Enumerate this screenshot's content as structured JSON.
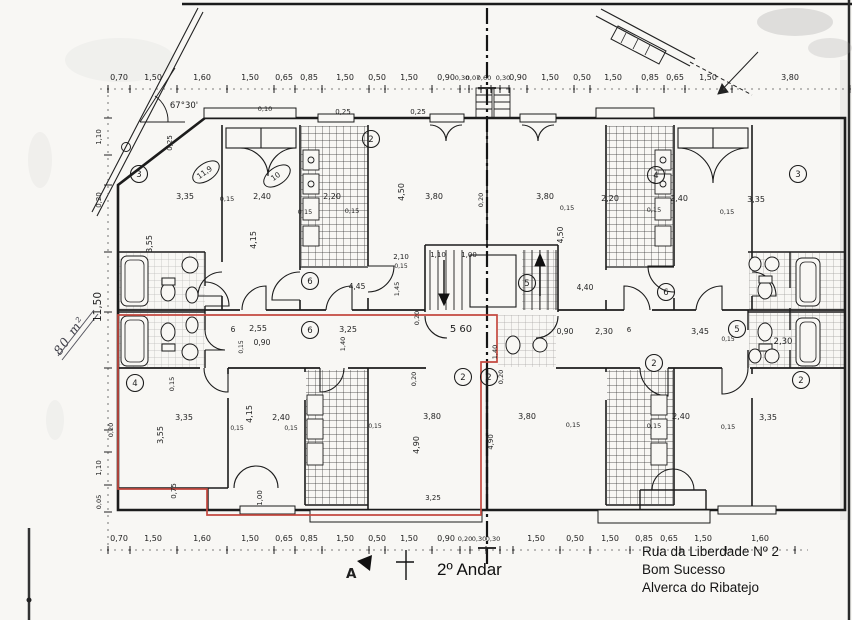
{
  "title": "2º Andar",
  "section": {
    "marker": "A"
  },
  "address": {
    "line1": "Rua da Liberdade Nº 2",
    "line2": "Bom Sucesso",
    "line3": "Alverca do Ribatejo"
  },
  "margin_notes": {
    "area_handwritten": "80 m²"
  },
  "colors": {
    "ink": "#1c1c1c",
    "red_outline": "#c4493f",
    "pencil": "#3c3c46",
    "paper": "#f8f7f4"
  },
  "dimension_chains": {
    "top": {
      "label_y": 80,
      "tick_y": 89,
      "ticks": [
        108,
        130,
        177,
        227,
        274,
        295,
        322,
        369,
        385,
        432,
        460,
        469,
        481,
        491,
        500,
        509,
        527,
        574,
        590,
        637,
        664,
        685,
        732,
        850
      ],
      "labels": [
        {
          "t": "0,70",
          "x": 119
        },
        {
          "t": "1,50",
          "x": 153
        },
        {
          "t": "1,60",
          "x": 202
        },
        {
          "t": "1,50",
          "x": 250
        },
        {
          "t": "0,65",
          "x": 284
        },
        {
          "t": "0,85",
          "x": 309
        },
        {
          "t": "1,50",
          "x": 345
        },
        {
          "t": "0,50",
          "x": 377
        },
        {
          "t": "1,50",
          "x": 409
        },
        {
          "t": "0,90",
          "x": 446
        },
        {
          "t": "0,30",
          "x": 462,
          "f": 6.5
        },
        {
          "t": "0,07",
          "x": 473,
          "f": 6.5
        },
        {
          "t": "0,60",
          "x": 484,
          "f": 6.5
        },
        {
          "t": "0,30",
          "x": 503,
          "f": 6.5
        },
        {
          "t": "0,90",
          "x": 518
        },
        {
          "t": "1,50",
          "x": 550
        },
        {
          "t": "0,50",
          "x": 582
        },
        {
          "t": "1,50",
          "x": 613
        },
        {
          "t": "0,85",
          "x": 650
        },
        {
          "t": "0,65",
          "x": 675
        },
        {
          "t": "1,50",
          "x": 708
        },
        {
          "t": "3,80",
          "x": 790
        }
      ]
    },
    "bottom": {
      "label_y": 541,
      "tick_y": 550,
      "ticks": [
        108,
        130,
        177,
        227,
        274,
        295,
        322,
        369,
        385,
        432,
        460,
        470,
        486,
        500,
        513,
        560,
        590,
        630,
        658,
        680,
        726,
        795
      ],
      "labels": [
        {
          "t": "0,70",
          "x": 119
        },
        {
          "t": "1,50",
          "x": 153
        },
        {
          "t": "1,60",
          "x": 202
        },
        {
          "t": "1,50",
          "x": 250
        },
        {
          "t": "0,65",
          "x": 284
        },
        {
          "t": "0,85",
          "x": 309
        },
        {
          "t": "1,50",
          "x": 345
        },
        {
          "t": "0,50",
          "x": 377
        },
        {
          "t": "1,50",
          "x": 409
        },
        {
          "t": "0,90",
          "x": 446
        },
        {
          "t": "0,20",
          "x": 465,
          "f": 6.5
        },
        {
          "t": "0,30",
          "x": 479,
          "f": 6.5
        },
        {
          "t": "0,30",
          "x": 493,
          "f": 6.5
        },
        {
          "t": "1,50",
          "x": 536
        },
        {
          "t": "0,50",
          "x": 575
        },
        {
          "t": "1,50",
          "x": 610
        },
        {
          "t": "0,85",
          "x": 644
        },
        {
          "t": "0,65",
          "x": 669
        },
        {
          "t": "1,50",
          "x": 703
        },
        {
          "t": "1,60",
          "x": 760
        }
      ]
    },
    "left": {
      "label_x": 101,
      "tick_x": 108,
      "ticks": [
        118,
        155,
        185,
        252,
        312,
        368,
        430,
        452,
        485,
        512
      ],
      "labels": [
        {
          "t": "1,10",
          "y": 137,
          "f": 7
        },
        {
          "t": "0,20",
          "y": 200,
          "f": 7
        },
        {
          "t": "11,50",
          "y": 307,
          "f": 10.5
        },
        {
          "t": "1,10",
          "y": 468,
          "f": 7
        },
        {
          "t": "0,05",
          "y": 502,
          "f": 6.5
        }
      ]
    }
  },
  "interior_dimensions": [
    {
      "t": "3,35",
      "x": 185,
      "y": 199
    },
    {
      "t": "0,15",
      "x": 227,
      "y": 201,
      "f": 6.5
    },
    {
      "t": "2,40",
      "x": 262,
      "y": 199
    },
    {
      "t": "0,15",
      "x": 305,
      "y": 214,
      "f": 6.5
    },
    {
      "t": "3,55",
      "x": 152,
      "y": 244,
      "r": -90
    },
    {
      "t": "4,15",
      "x": 256,
      "y": 240,
      "r": -90
    },
    {
      "t": "2,20",
      "x": 332,
      "y": 199
    },
    {
      "t": "0,15",
      "x": 352,
      "y": 213,
      "f": 6.5
    },
    {
      "t": "4,50",
      "x": 404,
      "y": 192,
      "r": -90
    },
    {
      "t": "3,80",
      "x": 434,
      "y": 199
    },
    {
      "t": "0,20",
      "x": 483,
      "y": 200,
      "r": -90,
      "f": 6.5
    },
    {
      "t": "2,10",
      "x": 401,
      "y": 259,
      "f": 7
    },
    {
      "t": "0,15",
      "x": 401,
      "y": 268,
      "f": 6
    },
    {
      "t": "1,10",
      "x": 438,
      "y": 257,
      "f": 7
    },
    {
      "t": "1,00",
      "x": 469,
      "y": 257,
      "f": 7
    },
    {
      "t": "0,25",
      "x": 343,
      "y": 114,
      "f": 7
    },
    {
      "t": "0,25",
      "x": 418,
      "y": 114,
      "f": 7
    },
    {
      "t": "0,10",
      "x": 265,
      "y": 111,
      "f": 6.5
    },
    {
      "t": "0,25",
      "x": 172,
      "y": 143,
      "r": -90,
      "f": 7
    },
    {
      "t": "67°30'",
      "x": 184,
      "y": 108,
      "f": 8.5
    },
    {
      "t": "4,45",
      "x": 357,
      "y": 289,
      "f": 7.5
    },
    {
      "t": "1,45",
      "x": 399,
      "y": 289,
      "r": -90,
      "f": 6.5
    },
    {
      "t": "6",
      "x": 233,
      "y": 332,
      "f": 7.5
    },
    {
      "t": "2,55",
      "x": 258,
      "y": 331
    },
    {
      "t": "0,90",
      "x": 262,
      "y": 345,
      "f": 7.5
    },
    {
      "t": "0,15",
      "x": 243,
      "y": 347,
      "r": -90,
      "f": 6
    },
    {
      "t": "1,40",
      "x": 345,
      "y": 344,
      "r": -90,
      "f": 6.5
    },
    {
      "t": "3,25",
      "x": 348,
      "y": 332
    },
    {
      "t": "5 60",
      "x": 461,
      "y": 332,
      "f": 10
    },
    {
      "t": "0,20",
      "x": 419,
      "y": 318,
      "r": -90,
      "f": 6.5
    },
    {
      "t": "1,40",
      "x": 497,
      "y": 352,
      "r": -90,
      "f": 6.5
    },
    {
      "t": "4,40",
      "x": 585,
      "y": 290,
      "f": 7.5
    },
    {
      "t": "0,90",
      "x": 565,
      "y": 334,
      "f": 7.5
    },
    {
      "t": "2,30",
      "x": 604,
      "y": 334
    },
    {
      "t": "6",
      "x": 629,
      "y": 332,
      "f": 7
    },
    {
      "t": "3,45",
      "x": 700,
      "y": 334
    },
    {
      "t": "0,15",
      "x": 728,
      "y": 341,
      "f": 6
    },
    {
      "t": "2,30",
      "x": 783,
      "y": 344,
      "f": 8.5
    },
    {
      "t": "2,20",
      "x": 610,
      "y": 201
    },
    {
      "t": "2,40",
      "x": 679,
      "y": 201
    },
    {
      "t": "3,35",
      "x": 756,
      "y": 202
    },
    {
      "t": "0,15",
      "x": 567,
      "y": 210,
      "f": 6.5
    },
    {
      "t": "0,15",
      "x": 654,
      "y": 212,
      "f": 6.5
    },
    {
      "t": "0,15",
      "x": 727,
      "y": 214,
      "f": 6.5
    },
    {
      "t": "3,80",
      "x": 545,
      "y": 199
    },
    {
      "t": "4,50",
      "x": 563,
      "y": 235,
      "r": -90,
      "f": 7.5
    },
    {
      "t": "3,35",
      "x": 184,
      "y": 420
    },
    {
      "t": "3,55",
      "x": 163,
      "y": 435,
      "r": -90
    },
    {
      "t": "0,15",
      "x": 174,
      "y": 384,
      "r": -90,
      "f": 6.5
    },
    {
      "t": "4,15",
      "x": 252,
      "y": 414,
      "r": -90
    },
    {
      "t": "2,40",
      "x": 281,
      "y": 420
    },
    {
      "t": "0,15",
      "x": 237,
      "y": 430,
      "f": 6
    },
    {
      "t": "0,15",
      "x": 291,
      "y": 430,
      "f": 6
    },
    {
      "t": "0,20",
      "x": 113,
      "y": 430,
      "r": -90,
      "f": 6.5
    },
    {
      "t": "1,00",
      "x": 262,
      "y": 498,
      "r": -90,
      "f": 7
    },
    {
      "t": "0,75",
      "x": 176,
      "y": 491,
      "r": -90,
      "f": 7
    },
    {
      "t": "3,80",
      "x": 432,
      "y": 419
    },
    {
      "t": "4,90",
      "x": 419,
      "y": 445,
      "r": -90
    },
    {
      "t": "0,20",
      "x": 416,
      "y": 379,
      "r": -90,
      "f": 6.5
    },
    {
      "t": "3,25",
      "x": 433,
      "y": 500,
      "f": 7
    },
    {
      "t": "0,15",
      "x": 375,
      "y": 428,
      "f": 6
    },
    {
      "t": "3,80",
      "x": 527,
      "y": 419
    },
    {
      "t": "4,90",
      "x": 493,
      "y": 442,
      "r": -90,
      "f": 7
    },
    {
      "t": "0,20",
      "x": 503,
      "y": 377,
      "r": -90,
      "f": 6.5
    },
    {
      "t": "0,15",
      "x": 573,
      "y": 427,
      "f": 6.5
    },
    {
      "t": "2,40",
      "x": 681,
      "y": 419
    },
    {
      "t": "3,35",
      "x": 768,
      "y": 420
    },
    {
      "t": "0,15",
      "x": 654,
      "y": 428,
      "f": 6.5
    },
    {
      "t": "0,15",
      "x": 728,
      "y": 429,
      "f": 6.5
    }
  ],
  "room_tags": [
    {
      "n": "3",
      "x": 139,
      "y": 174
    },
    {
      "n": "2",
      "x": 371,
      "y": 139
    },
    {
      "n": "4",
      "x": 656,
      "y": 175
    },
    {
      "n": "3",
      "x": 798,
      "y": 174
    },
    {
      "n": "6",
      "x": 310,
      "y": 281
    },
    {
      "n": "5",
      "x": 527,
      "y": 283
    },
    {
      "n": "6",
      "x": 666,
      "y": 292
    },
    {
      "n": "6",
      "x": 310,
      "y": 330
    },
    {
      "n": "5",
      "x": 737,
      "y": 329
    },
    {
      "n": "4",
      "x": 135,
      "y": 383
    },
    {
      "n": "2",
      "x": 463,
      "y": 377
    },
    {
      "n": "2",
      "x": 489,
      "y": 377
    },
    {
      "n": "2",
      "x": 654,
      "y": 363
    },
    {
      "n": "2",
      "x": 801,
      "y": 380
    }
  ],
  "area_tags": [
    {
      "t": "11,9",
      "x": 206,
      "y": 172,
      "r": -35
    },
    {
      "t": "10",
      "x": 277,
      "y": 176,
      "r": -35
    }
  ]
}
